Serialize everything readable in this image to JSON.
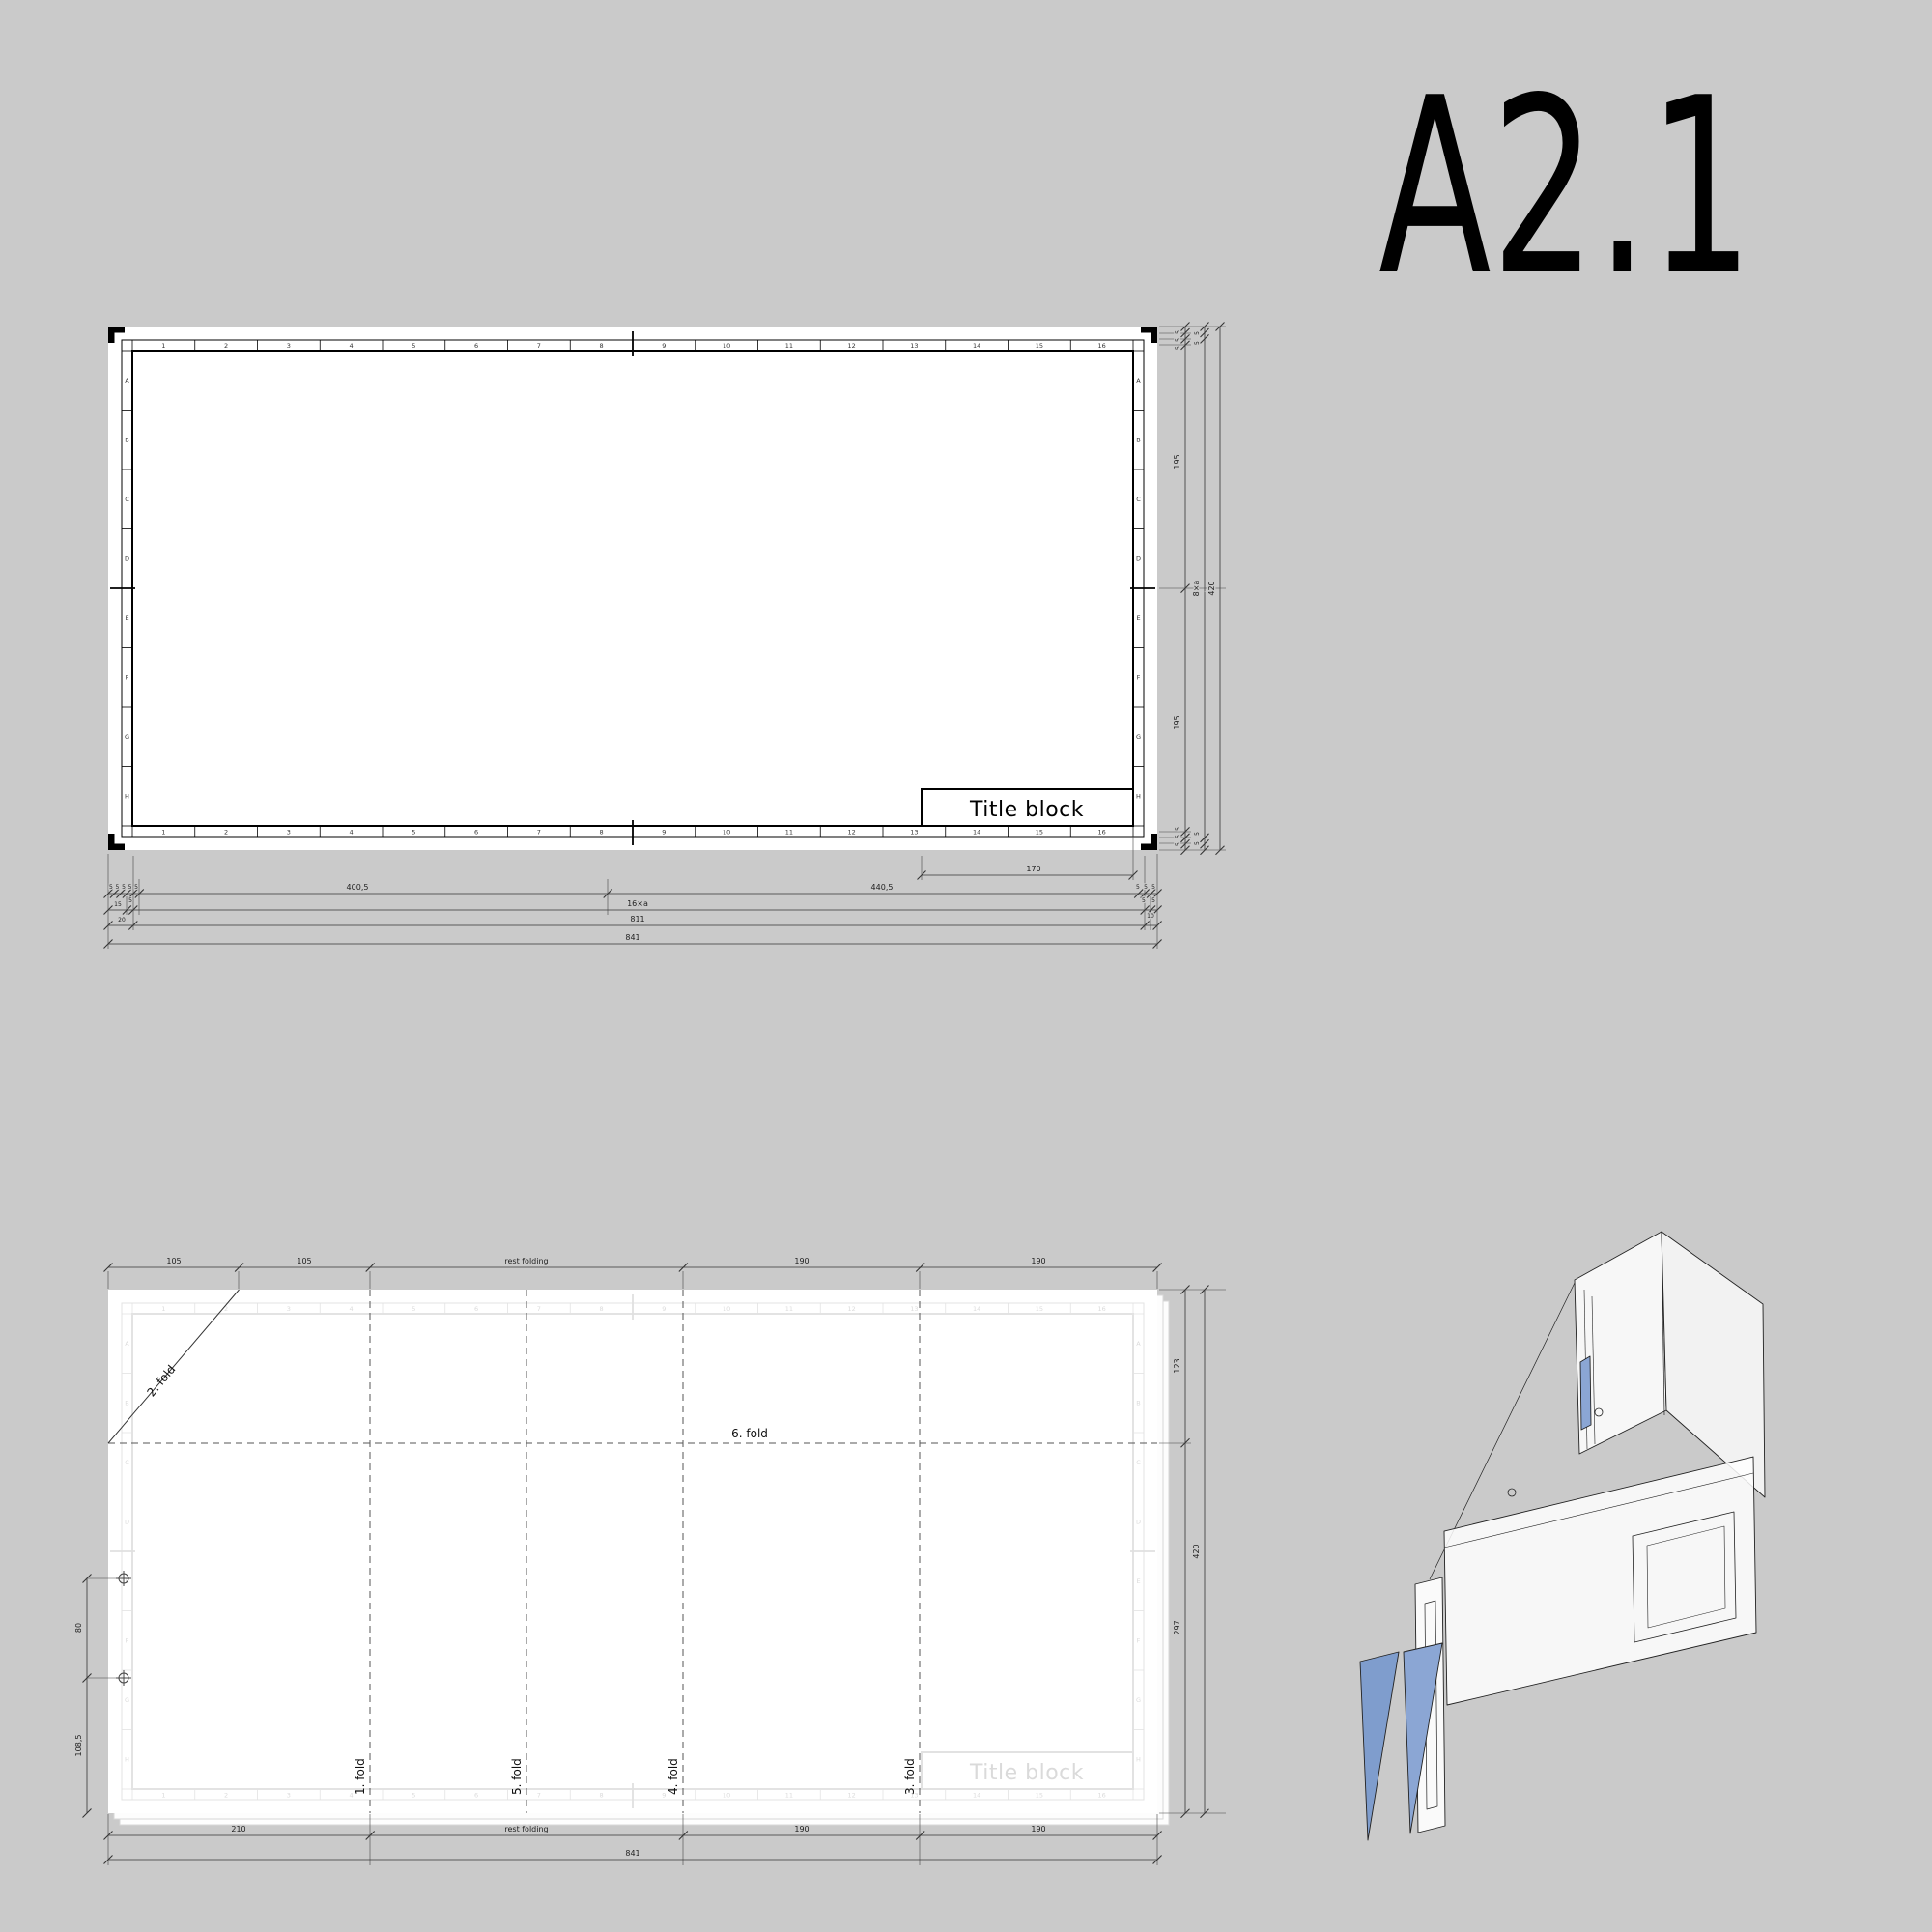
{
  "title": "A2.1",
  "colors": {
    "background": "#cacaca",
    "paper": "#ffffff",
    "frame_line": "#000000",
    "dim_line": "#333333",
    "fold_line": "#555555",
    "ghost_line": "#e3e3e3",
    "ghost_text": "#d9d9d9",
    "gusset_blue": "#8ba6d4",
    "gusset_blue_dark": "#7f9dcd"
  },
  "sheet": {
    "title_block_label": "Title block",
    "grid": {
      "columns": [
        "1",
        "2",
        "3",
        "4",
        "5",
        "6",
        "7",
        "8",
        "9",
        "10",
        "11",
        "12",
        "13",
        "14",
        "15",
        "16"
      ],
      "rows": [
        "A",
        "B",
        "C",
        "D",
        "E",
        "F",
        "G",
        "H"
      ]
    }
  },
  "dims_top": {
    "row1_margins_left": "5 5 5 5 5",
    "row1_left": "400,5",
    "row1_right": "440,5",
    "row1_margins_right": "5 5 5",
    "title_block_width": "170",
    "row2_left_a": "15",
    "row2_left_b": "5",
    "row2_mid": "16×a",
    "row2_right": "5 5",
    "row3_left": "20",
    "row3_mid": "811",
    "row3_right": "10",
    "row4_total": "841",
    "col1_margins_top": "5 5 5",
    "col1_upper": "195",
    "col1_lower": "195",
    "col1_margins_bottom": "5 5 5",
    "col2_margins_top": "5 5",
    "col2_mid": "8×a",
    "col2_margins_bottom": "5 5",
    "col3_total": "420"
  },
  "dims_fold": {
    "top": [
      "105",
      "105",
      "rest folding",
      "190",
      "190"
    ],
    "bottom": [
      "210",
      "rest folding",
      "190",
      "190"
    ],
    "bottom_total": "841",
    "right_upper": "123",
    "right_lower": "297",
    "right_total": "420",
    "hole_spacing": "80",
    "hole_offset": "108,5"
  },
  "fold_labels": {
    "f1": "1. fold",
    "f2": "2. fold",
    "f3": "3. fold",
    "f4": "4. fold",
    "f5": "5. fold",
    "f6": "6. fold"
  }
}
